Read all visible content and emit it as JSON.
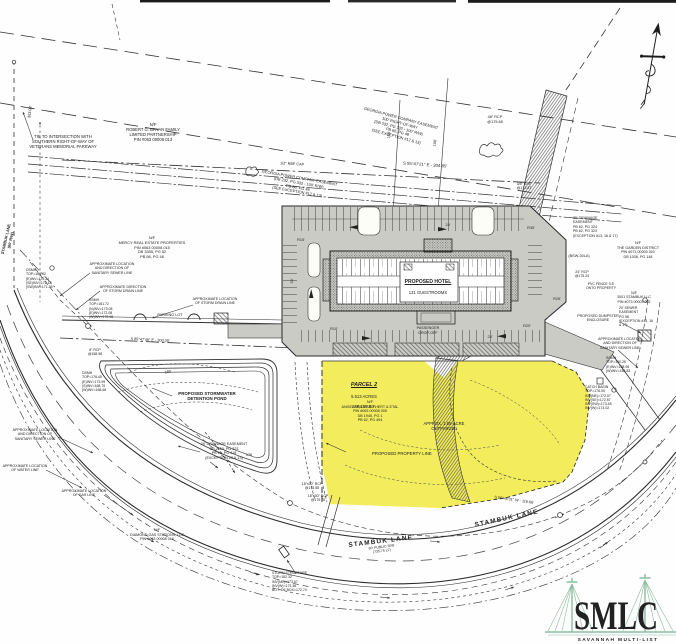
{
  "colors": {
    "highlight_yellow": "#f2ec50",
    "pavement_gray": "#cbcbc6",
    "ink": "#2a2a2a",
    "logo_green": "#7fb292"
  },
  "road": {
    "name_sw": "STAMBUK LANE",
    "rw_note_sw": "60' PUBLIC R/W\n(735.75 LF)",
    "name_se": "STAMBUK LANE",
    "name_nw_vertical": "STAMBUK LANE\n(60' R/W)"
  },
  "parcel2": {
    "title": "PARCEL 2",
    "area_acres": "5.513 ACRES",
    "area_sf": "240,157 S.F.",
    "owner": "N/F\nANGELA RICHARD HERT & ETAL\nPIN #063 00008 005\nDB 1945, PG 1\nPB 62, PG 494",
    "outparcel_note": "APPROX. 1.55-ACRE\nOUTPARCEL",
    "property_line_note": "PROPOSED PROPERTY LINE",
    "bearing_south": "S 56°46'31\" W - 116.66'"
  },
  "building": {
    "name": "PROPOSED HOTEL",
    "rooms": "131 GUESTROOMS",
    "dropoff": "PASSENGER\nDROP-OFF",
    "parking_lot": "PARKING LOT",
    "dumpster": "PROPOSED DUMPSTER\nENCLOSURE"
  },
  "pond": {
    "label": "PROPOSED STORMWATER\nDETENTION POND",
    "contour_180": "180",
    "contour_178": "178"
  },
  "owners": {
    "bryan": "N/F\nROBERT G. BRYAN FAMILY\nLIMITED PARTNERSHIP\nPIN #063 00008 013",
    "mercy": "N/F\nMERCY REAL ESTATE PROPERTIES\nPIN #063 00008 015\nDB 3355, PG 52\nPB 68, PG 48",
    "diamond": "N/F\nDIAMOND GAS STATIONS, LLC\nPIN #063 00008 016",
    "garden": "N/F\nTHE GARDEN DISTRICT\nPIN #073 00003 001\nDB 1036, PG 148",
    "stambuk_llc": "N/F\n3001 STAMBUK LLC\nPIN #073 00003 002"
  },
  "easements": {
    "georgia_power_1": "GEORGIA POWER COMPANY EASEMENT\n100' RIGHT-OF-WAY\n(DB 232, PG 332 - 100' R/W)\nPB 66, PG 48\n(SEE EXCEPTION #12 & 13)",
    "georgia_power_2": "GEORGIA POWER COMPANY EASEMENT\n(DB 232, PG 332 - 100' R/W)\nPB 66, PG 48\n(SEE EXCEPTION #12 & 13)",
    "drainage_west": "20' DRAINAGE EASEMENT\nDB 2150, PG 323\nPB 62, PG 418\n(EXCEPTION #3 & 13)",
    "drainage_east": "30' DRAINAGE\nEASEMENT\nPB 62, PG 324\nPB 62, PG 323\n(EXCEPTION #13, 16 & 17)",
    "sewer_east": "20' SEWER\nEASEMENT\nPG 58\n(EXCEPTION #13, 16\n& 17)"
  },
  "utilities": {
    "sanitary_nw": "APPROXIMATE LOCATION\nAND DIRECTION OF\nSANITARY SEWER LINE",
    "storm_direction_nw": "APPROXIMATE DIRECTION\nOF STORM DRAIN LINE",
    "storm_location_n": "APPROXIMATE LOCATION\nOF STORM DRAIN LINE",
    "sanitary_sw": "APPROXIMATE LOCATION\nAND DIRECTION OF\nSANITARY SEWER LINE",
    "water_sw": "APPROXIMATE LOCATION\nOF WATER LINE",
    "gas_sw": "APPROXIMATE LOCATION\nOF GAS LINE",
    "sanitary_e": "APPROXIMATE LOCATION\nAND DIRECTION OF\nSANITARY SEWER LINE",
    "pvc_fence": "PVC FENCE 0.5'\nONTO PROPERTY"
  },
  "structures": {
    "dsmh_1": "DSMH\nTOP=180.92\n(E)INV=175.21\n(SE)INV=172.18\n(SW)INV=171.35",
    "ssmh_1": "SSMH\nTOP=181.72\n(N)INV=173.08\n(E)INV=172.08\n(W)INV=170.98",
    "dsmh_2": "DSMH\nTOP=176.45\n(E)INV=173.99\n(S)INV=168.70\n(W)INV=168.66",
    "ssmh_2": "SSMH\nTOP=190.25\n(E)INV=158.95\n(W)INV=158.83",
    "catch_basin": "CATCH BASIN\nTOP=176.00\nINV(NE)=172.07\nINV(SE)=172.57\nINV(SW)=173.45\nINV(W)=174.02",
    "storm_structure": "STORM STRUCTURE\nTOP=182.32\nINV(NE)=173.67\nINV(W)=173.36\nBOT. OF BOX=172.74",
    "rcp_48": "48\" RCP\n@175.68",
    "rcp_24": "24\" RCP\n@175.24",
    "rcp_8": "8\" RCP\n@158.98",
    "rcp_18x30_a": "18\"x30\" RCP\n@175.58",
    "rcp_18x30_b": "18\"x30\" RCP\n@175.78",
    "crf_38": "3/8\" CRF\n@173.87"
  },
  "survey": {
    "tie_note": "TIE TO INTERSECTION WITH\nSOUTHERN RIGHT-OF-WAY OF\nVETERANS MEMORIAL PARKWAY",
    "bearing_north": "S 85°47'21\" E - 304.85'",
    "bearing_frontage": "S 85°47'46\" E - 300.00'",
    "dist_west": "363.08'",
    "dim_100_a": "100'",
    "dim_100_b": "100'",
    "rbf_cap": "1/2\" RBF CAP",
    "code_note": "(BSW-30LA)"
  },
  "dims": {
    "aisle_24_a": "24'",
    "aisle_24_b": "24'",
    "aisle_34": "34'",
    "r15": "R15'",
    "r35": "R35'",
    "r10": "R10'",
    "r20": "R20'",
    "r25": "R25'"
  },
  "logo": {
    "acronym": "SMLC",
    "line1": "SAVANNAH MULTI-LIST",
    "line2": "CORPORATION"
  }
}
